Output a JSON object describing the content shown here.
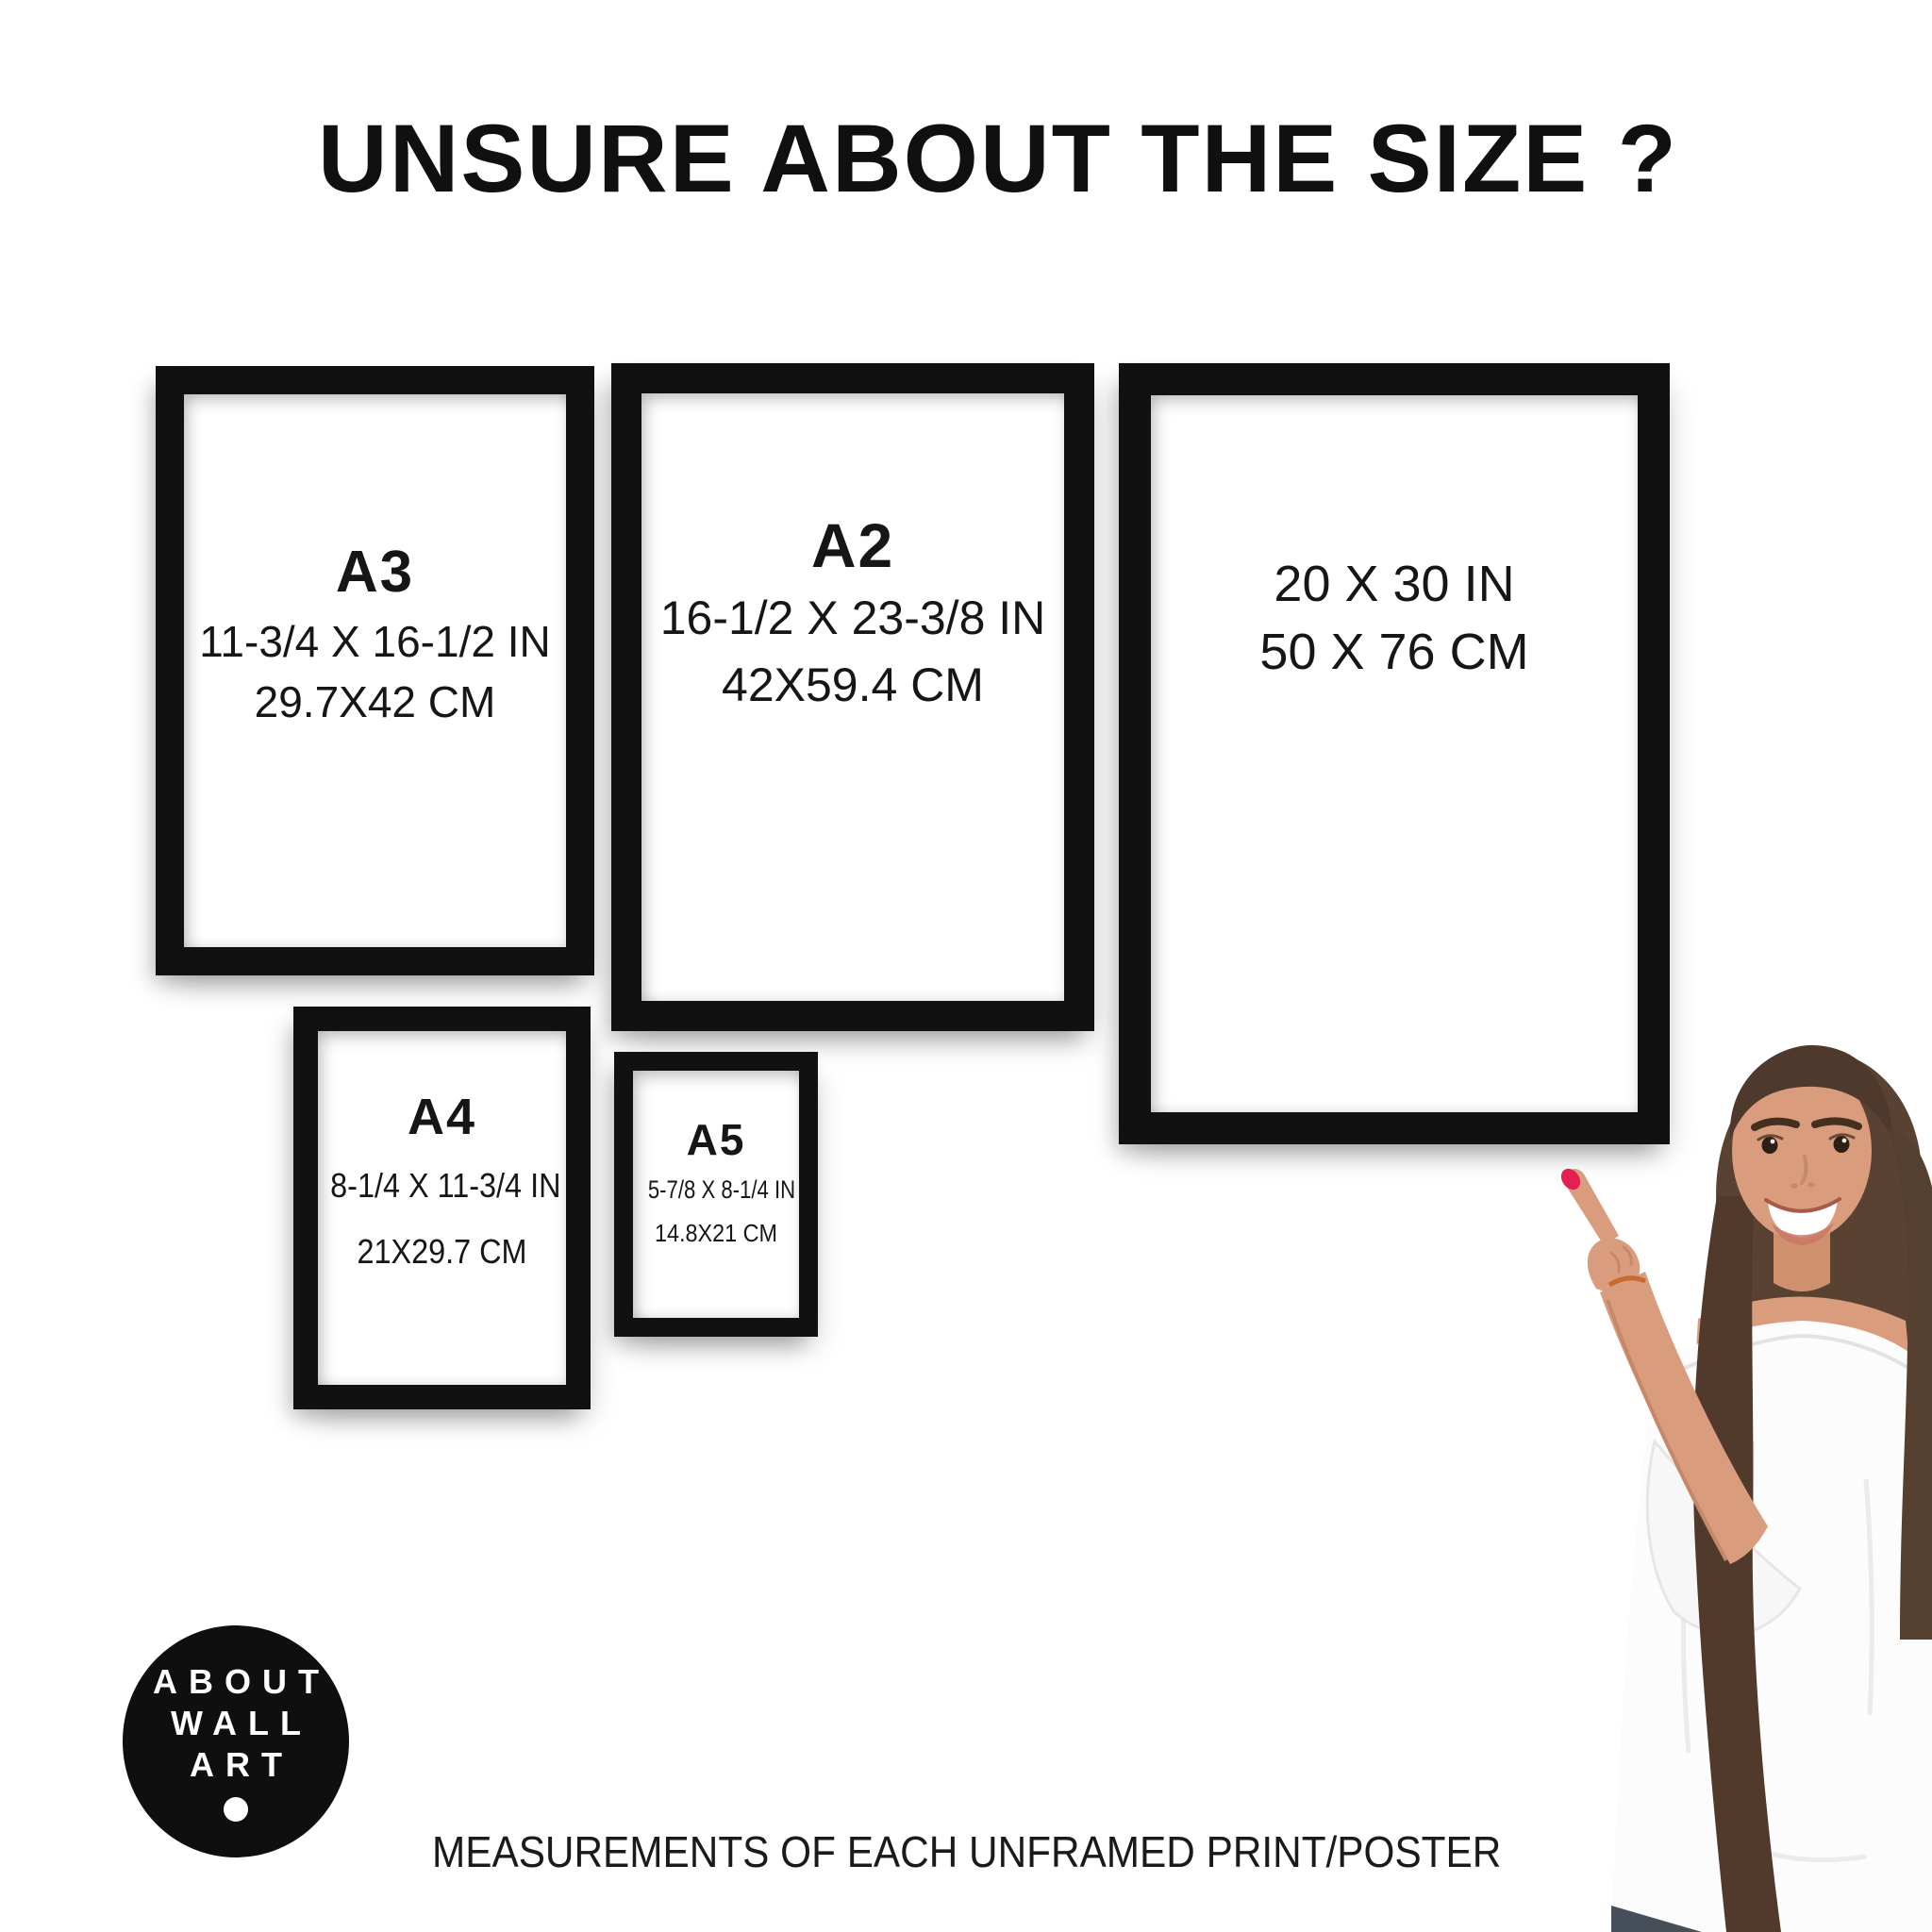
{
  "page": {
    "title": "UNSURE ABOUT THE SIZE ?",
    "caption": "MEASUREMENTS OF EACH UNFRAMED PRINT/POSTER"
  },
  "logo": {
    "line1": "ABOUT",
    "line2": "WALL",
    "line3": "ART"
  },
  "frames": {
    "a3": {
      "name": "A3",
      "inches": "11-3/4 X 16-1/2 IN",
      "cm": "29.7X42 CM"
    },
    "a2": {
      "name": "A2",
      "inches": "16-1/2 X 23-3/8 IN",
      "cm": "42X59.4 CM"
    },
    "poster2030": {
      "inches": "20 X 30 IN",
      "cm": "50 X 76 CM"
    },
    "a4": {
      "name": "A4",
      "inches": "8-1/4 X 11-3/4 IN",
      "cm": "21X29.7 CM"
    },
    "a5": {
      "name": "A5",
      "inches": "5-7/8 X 8-1/4 IN",
      "cm": "14.8X21 CM"
    }
  },
  "colors": {
    "frame": "#111111",
    "text": "#1b1b1b",
    "logo_bg": "#0f0f0f",
    "logo_text": "#ffffff",
    "nail": "#e51e53"
  }
}
